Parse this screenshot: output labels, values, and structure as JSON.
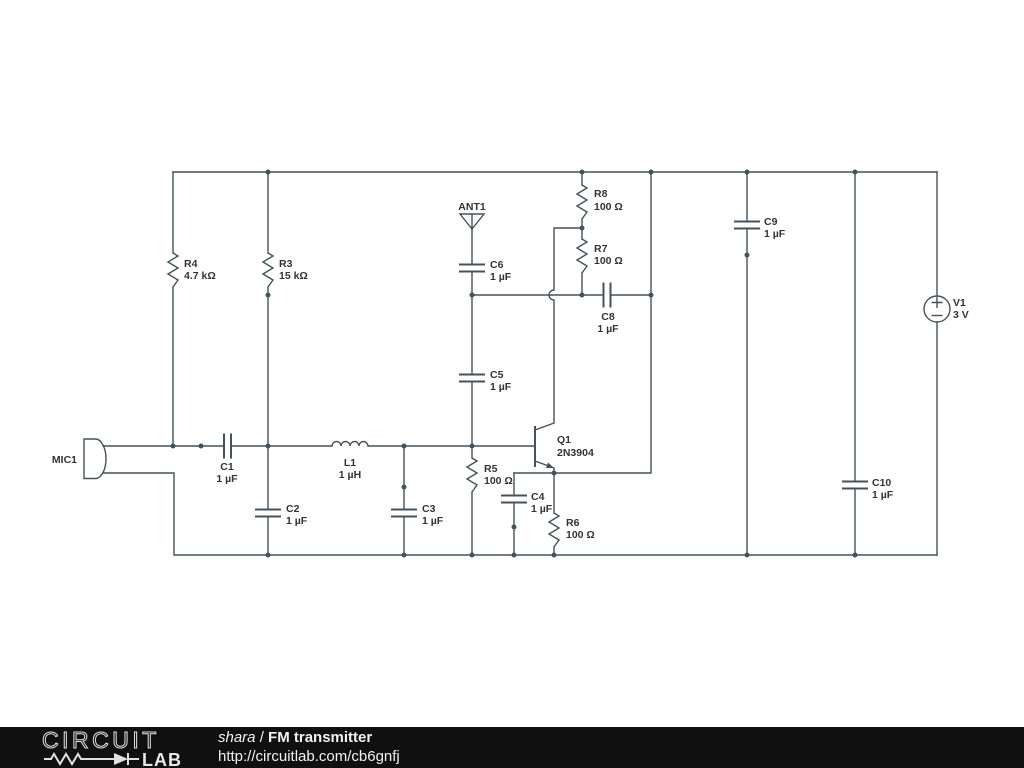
{
  "colors": {
    "wire": "#46525a",
    "component_label": "#333333",
    "footer_background": "#101010",
    "footer_text": "#f2f2f2"
  },
  "components": {
    "mic1": {
      "ref": "MIC1"
    },
    "r4": {
      "ref": "R4",
      "value": "4.7 kΩ"
    },
    "r3": {
      "ref": "R3",
      "value": "15 kΩ"
    },
    "c1": {
      "ref": "C1",
      "value": "1 µF"
    },
    "c2": {
      "ref": "C2",
      "value": "1 µF"
    },
    "l1": {
      "ref": "L1",
      "value": "1 µH"
    },
    "c3": {
      "ref": "C3",
      "value": "1 µF"
    },
    "ant1": {
      "ref": "ANT1"
    },
    "c6": {
      "ref": "C6",
      "value": "1 µF"
    },
    "c5": {
      "ref": "C5",
      "value": "1 µF"
    },
    "r8": {
      "ref": "R8",
      "value": "100 Ω"
    },
    "r7": {
      "ref": "R7",
      "value": "100 Ω"
    },
    "c8": {
      "ref": "C8",
      "value": "1 µF"
    },
    "r5": {
      "ref": "R5",
      "value": "100 Ω"
    },
    "q1": {
      "ref": "Q1",
      "value": "2N3904"
    },
    "c4": {
      "ref": "C4",
      "value": "1 µF"
    },
    "r6": {
      "ref": "R6",
      "value": "100 Ω"
    },
    "c9": {
      "ref": "C9",
      "value": "1 µF"
    },
    "c10": {
      "ref": "C10",
      "value": "1 µF"
    },
    "v1": {
      "ref": "V1",
      "value": "3 V"
    }
  },
  "footer": {
    "logo_top": "CIRCUIT",
    "logo_bottom": "LAB",
    "author": "shara",
    "divider": " / ",
    "project_title": "FM transmitter",
    "url": "http://circuitlab.com/cb6gnfj"
  }
}
